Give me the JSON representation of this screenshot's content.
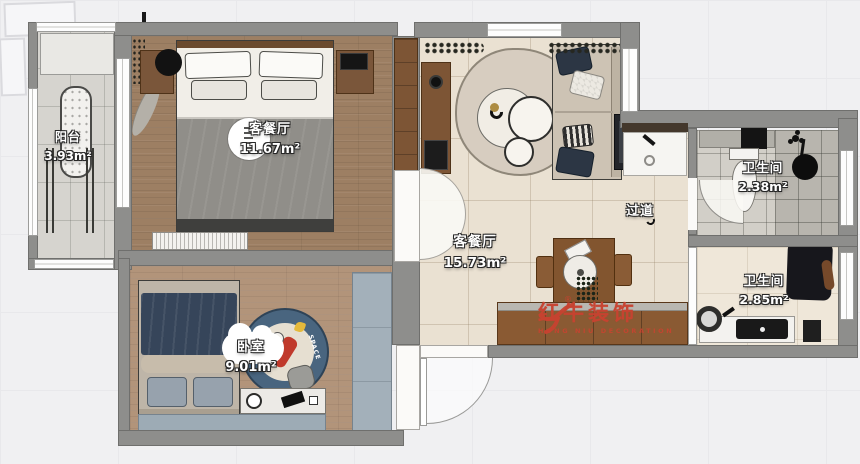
{
  "plan": {
    "balcony": {
      "name": "阳台",
      "area": "3.93m²"
    },
    "bedroom_main": {
      "name": "客餐厅",
      "area": "11.67m²"
    },
    "living_dining": {
      "name": "客餐厅",
      "area": "15.73m²"
    },
    "hallway": {
      "name": "过道"
    },
    "bathroom_top": {
      "name": "卫生间",
      "area": "2.38m²"
    },
    "bathroom_bottom": {
      "name": "卫生间",
      "area": "2.85m²"
    },
    "bedroom_second": {
      "name": "卧室",
      "area": "9.01m²"
    }
  },
  "watermark": {
    "name": "红牛装饰",
    "subtitle": "HONG NIU DECORATION",
    "registered": "®",
    "brand_color": "#c74230"
  },
  "decor": {
    "rug_text": "SPACE"
  }
}
